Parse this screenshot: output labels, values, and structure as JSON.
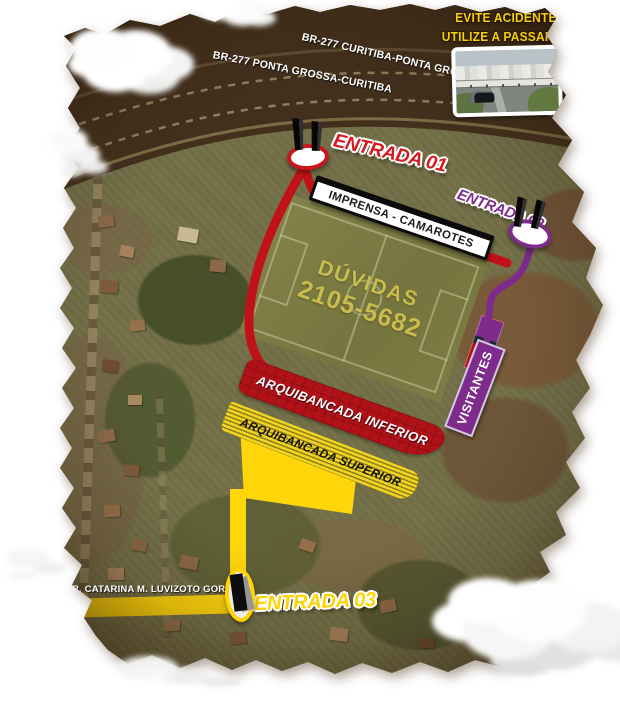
{
  "notice": {
    "line1": "EVITE ACIDENTES",
    "line2": "UTILIZE A PASSARELA"
  },
  "highways": {
    "eastbound": "BR-277  CURITIBA-PONTA GROSSA",
    "westbound": "BR-277 PONTA GROSSA-CURITIBA"
  },
  "street_name": "R. CATARINA M. LUVIZOTO GORDA",
  "entrances": {
    "e1": {
      "label": "ENTRADA 01",
      "color": "#c8161d"
    },
    "e2": {
      "label": "ENTRADA 02",
      "color": "#7d2c8c"
    },
    "e3": {
      "label": "ENTRADA 03",
      "color": "#ffd400"
    }
  },
  "stands": {
    "imprensa": "IMPRENSA - CAMAROTES",
    "visitantes": "VISITANTES",
    "inferior": "ARQUIBANCADA INFERIOR",
    "superior": "ARQUIBANCADA SUPERIOR"
  },
  "field": {
    "doubts": "DÚVIDAS",
    "phone": "2105-5682"
  },
  "colors": {
    "route_entrance1": "#c8161d",
    "route_entrance2": "#7d2c8c",
    "route_entrance3": "#ffd60a",
    "stand_inferior": "#b01218",
    "stand_superior": "#f0d41f",
    "field_text": "#c9bc4e",
    "notice_text": "#f2cf0a"
  }
}
